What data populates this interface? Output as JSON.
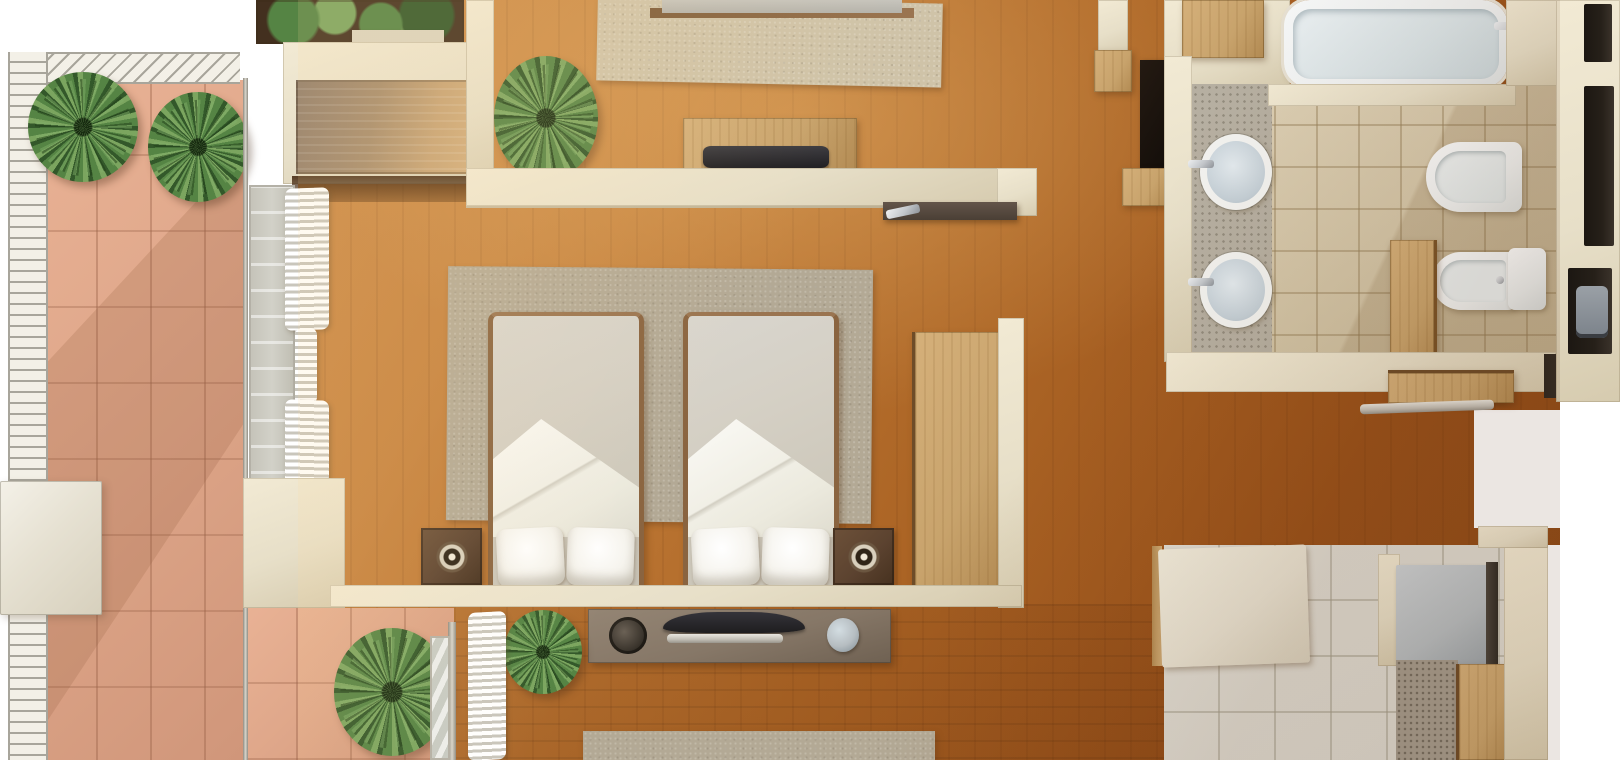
{
  "meta": {
    "type": "3d-rendered-floor-plan",
    "view": "top-down isometric render",
    "description": "Photorealistic overhead 3D floor plan of an apartment: left terrace with terracotta tiles, white slatted railing and potted palms; twin bedroom with two single beds, grey rug, nightstands with round speakers and tall wardrobe; partial upper and lower bedrooms; wood-floor hallway; bathroom with bathtub, two round sinks, toilet, bidet and storage niches; partial right bedroom with pale tile floor."
  },
  "palette": {
    "white_bg": "#ffffff",
    "wall": "#e7dfc8",
    "wall_bright": "#f2ead4",
    "wall_shade": "#d6cbaf",
    "terra": "#dfa78a",
    "railing": "#f3f0e7",
    "railing_line": "#a8a59b",
    "wood_light": "#cf8e4b",
    "wood_dark": "#8a4817",
    "rug": "#b3a995",
    "rug_top_room": "#cfc3a8",
    "plant_dark": "#33582a",
    "plant_mid": "#558444",
    "plant_light": "#7ba55f",
    "soil": "#43301f",
    "mattress": "#d5d0c5",
    "pillow": "#f6f4ee",
    "bedframe": "#8a6440",
    "nightstand": "#5c4330",
    "lightwood": "#c8a36c",
    "tile": "#d6c8ac",
    "mosaic": "#b6afa1",
    "porcelain": "#f0f2f2",
    "porcelain_in": "#d9e3e6",
    "chrome": "#c3c7cb",
    "tv": "#1e1d1f",
    "console": "#867767",
    "silver": "#c2beb5",
    "glass": "#d2d1c8",
    "track": "#b4b1a7",
    "curtain_shade": "#c9c6bc",
    "niche": "#262019",
    "grey_cab": "#b6bdc1",
    "pale_tile": "#dbd8cf",
    "speckle": "#a49b8d"
  },
  "rooms": [
    {
      "id": "terrace",
      "label": "Terrace",
      "features": [
        "terracotta tile floor",
        "white slatted railing",
        "two potted palms",
        "outdoor unit box",
        "corner palm"
      ]
    },
    {
      "id": "upper-bedroom",
      "label": "Upper bedroom (partial)",
      "features": [
        "beige area rug",
        "bed cut off at top edge",
        "wall console with laptop",
        "potted palm",
        "built-in wardrobe",
        "planter box with greenery"
      ]
    },
    {
      "id": "twin-bedroom",
      "label": "Twin bedroom",
      "features": [
        "two single beds with folded white sheets and pillows",
        "grey area rug",
        "two dark nightstands with round speakers",
        "tall light-wood wardrobe",
        "glazed wall with bunched white curtains",
        "floating desk with chrome handle"
      ]
    },
    {
      "id": "lower-bedroom",
      "label": "Lower bedroom (partial)",
      "features": [
        "wall media console",
        "TV",
        "soundbar",
        "potted plant",
        "blue speaker ball",
        "fern",
        "sliding door with white curtain",
        "area rug cut off at bottom edge"
      ]
    },
    {
      "id": "hallway",
      "label": "Hallway",
      "features": [
        "wood flooring",
        "dark mirror panel",
        "wood wall shelf",
        "wood bench with rail"
      ]
    },
    {
      "id": "bathroom",
      "label": "Bathroom",
      "features": [
        "bathtub with chrome faucet",
        "two round countertop sinks",
        "toilet",
        "bidet",
        "tall wood cabinet",
        "beige tile floor",
        "pebble mosaic strip",
        "storage wall with dark niches",
        "grey canister"
      ]
    },
    {
      "id": "right-bedroom",
      "label": "Right bedroom (partial)",
      "features": [
        "bed with cream duvet",
        "grey cabinet",
        "wood bench",
        "speckled rug",
        "pale tile floor"
      ]
    }
  ]
}
